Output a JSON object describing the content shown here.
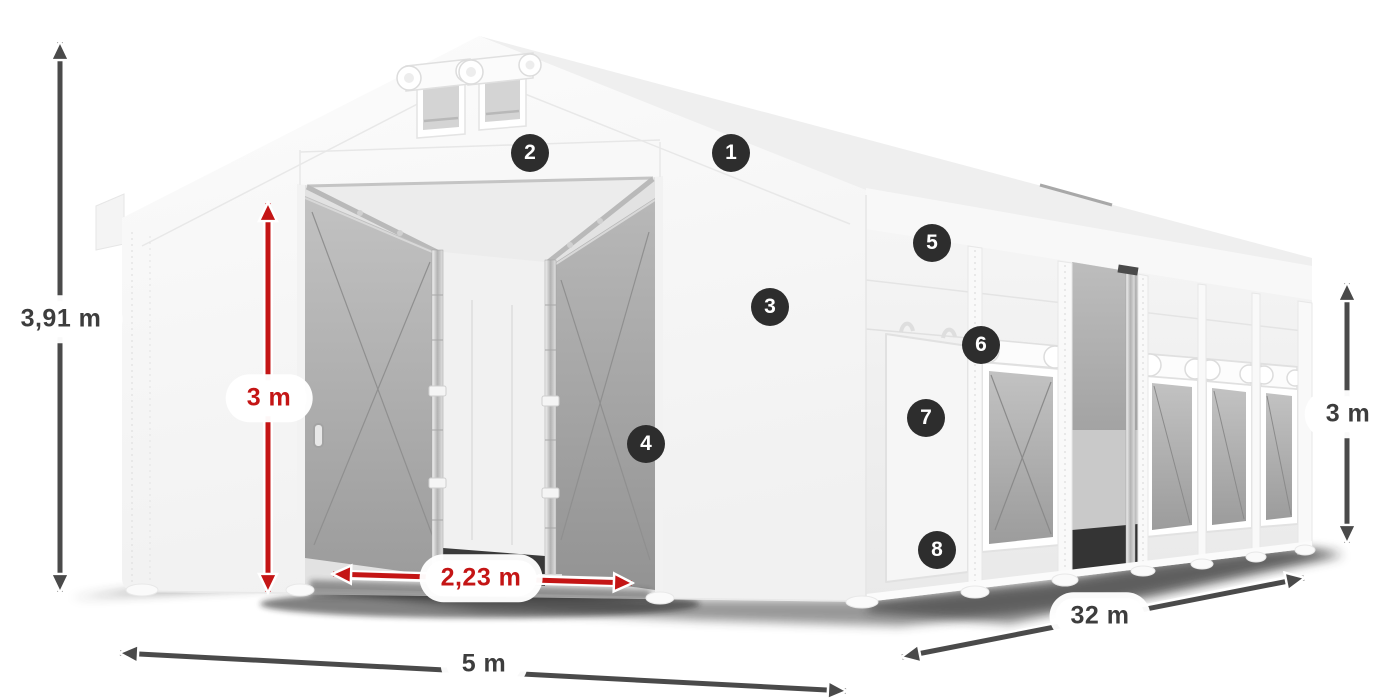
{
  "diagram": {
    "subject": "white storage tent with dimension annotations"
  },
  "dimensions": {
    "total_height": "3,91 m",
    "door_height": "3 m",
    "door_width": "2,23 m",
    "front_width": "5 m",
    "side_length": "32 m",
    "side_height": "3 m"
  },
  "callouts": [
    {
      "number": "1"
    },
    {
      "number": "2"
    },
    {
      "number": "3"
    },
    {
      "number": "4"
    },
    {
      "number": "5"
    },
    {
      "number": "6"
    },
    {
      "number": "7"
    },
    {
      "number": "8"
    }
  ],
  "colors": {
    "dimension_dark": "#4a4a4a",
    "dimension_red": "#c41515",
    "callout_bg": "#2d2d2d"
  }
}
